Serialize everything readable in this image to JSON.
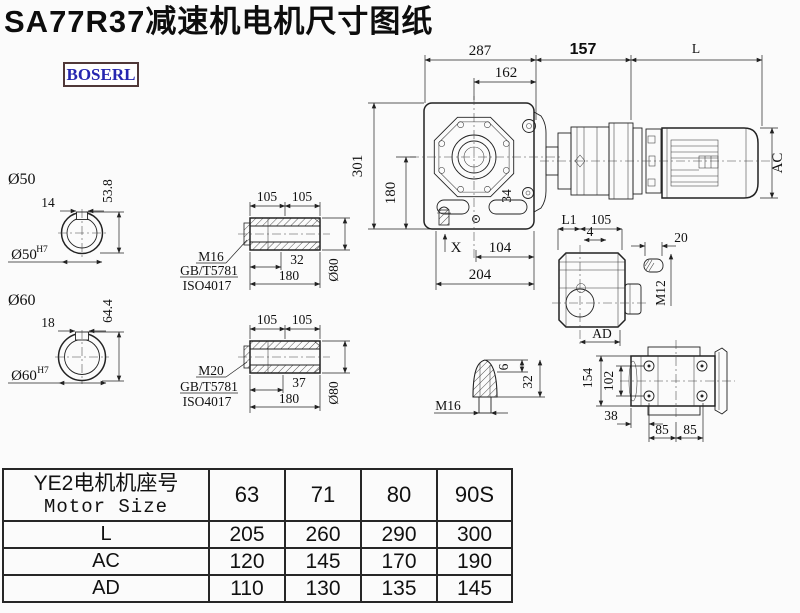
{
  "title": "SA77R37减速机电机尺寸图纸",
  "logo": {
    "text": "BOSERL"
  },
  "colors": {
    "line": "#222222",
    "logo_text": "#2626b0",
    "logo_border": "#503838",
    "background": "#fbfbfb"
  },
  "main_view": {
    "dim_287": "287",
    "dim_162": "162",
    "dim_157": "157",
    "dim_L": "L",
    "dim_AC": "AC",
    "dim_301": "301",
    "dim_180": "180",
    "dim_34": "34",
    "label_X": "X",
    "dim_104": "104",
    "dim_204": "204"
  },
  "bore_50": {
    "title": "Ø50",
    "key_width": "14",
    "key_depth": "53.8",
    "bore": "Ø50",
    "tol": "H7"
  },
  "bore_60": {
    "title": "Ø60",
    "key_width": "18",
    "key_depth": "64.4",
    "bore": "Ø60",
    "tol": "H7"
  },
  "shaft_m16": {
    "dim_105a": "105",
    "dim_105b": "105",
    "dim_len": "32",
    "dim_180": "180",
    "dim_dia": "Ø80",
    "bolt": "M16",
    "std1": "GB/T5781",
    "std2": "ISO4017"
  },
  "shaft_m20": {
    "dim_105a": "105",
    "dim_105b": "105",
    "dim_len": "37",
    "dim_180": "180",
    "dim_dia": "Ø80",
    "bolt": "M20",
    "std1": "GB/T5781",
    "std2": "ISO4017"
  },
  "side_view": {
    "dim_L1": "L1",
    "dim_105": "105",
    "dim_4": "4",
    "dim_AD": "AD"
  },
  "key_detail": {
    "dim_20": "20",
    "thread": "M12"
  },
  "shaft_end": {
    "dim_6": "6",
    "dim_32": "32",
    "thread": "M16"
  },
  "flange_view": {
    "dim_154": "154",
    "dim_102": "102",
    "dim_38": "38",
    "dim_85a": "85",
    "dim_85b": "85"
  },
  "table": {
    "header_line1": "YE2电机机座号",
    "header_line2": "Motor Size",
    "columns": [
      "63",
      "71",
      "80",
      "90S"
    ],
    "rows": [
      {
        "label": "L",
        "values": [
          "205",
          "260",
          "290",
          "300"
        ]
      },
      {
        "label": "AC",
        "values": [
          "120",
          "145",
          "170",
          "190"
        ]
      },
      {
        "label": "AD",
        "values": [
          "110",
          "130",
          "135",
          "145"
        ]
      }
    ]
  }
}
